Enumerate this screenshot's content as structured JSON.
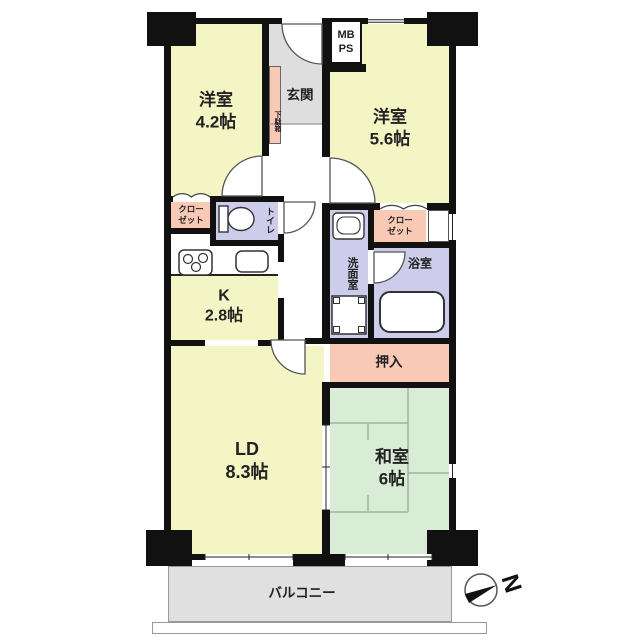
{
  "plan_title": "apartment-floor-plan",
  "rooms": {
    "western1": {
      "label": "洋室",
      "area": "4.2帖"
    },
    "western2": {
      "label": "洋室",
      "area": "5.6帖"
    },
    "entrance": {
      "label": "玄関"
    },
    "shoe_cabinet": {
      "label": "下駄箱"
    },
    "meter_box": {
      "line1": "MB",
      "line2": "PS"
    },
    "closet_left": {
      "line1": "クロー",
      "line2": "ゼット"
    },
    "toilet": {
      "label": "トイレ"
    },
    "kitchen": {
      "label": "K",
      "area": "2.8帖"
    },
    "washroom": {
      "label": "洗面室"
    },
    "closet_right": {
      "line1": "クロー",
      "line2": "ゼット"
    },
    "bathroom": {
      "label": "浴室"
    },
    "futon_closet": {
      "label": "押入"
    },
    "living_dining": {
      "label": "LD",
      "area": "8.3帖"
    },
    "japanese_room": {
      "label": "和室",
      "area": "6帖"
    },
    "balcony": {
      "label": "バルコニー"
    }
  },
  "compass": {
    "label": "N"
  },
  "colors": {
    "room_yellow": "#f3f5c4",
    "tatami_green": "#d9ecd6",
    "wet_lavender": "#cdcdeb",
    "storage_pink": "#f8c9b4",
    "floor_gray": "#e0e0e0",
    "wall_black": "#111111"
  }
}
